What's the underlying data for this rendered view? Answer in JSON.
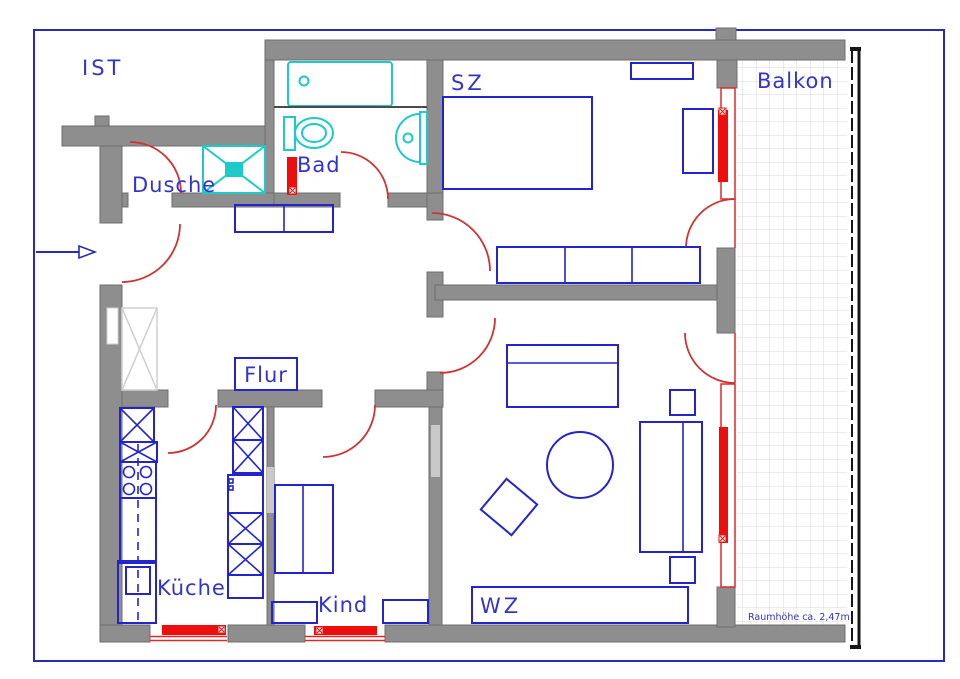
{
  "plan": {
    "rooms": [
      {
        "id": "ist",
        "label": "IST"
      },
      {
        "id": "dusche",
        "label": "Dusche"
      },
      {
        "id": "bad",
        "label": "Bad"
      },
      {
        "id": "sz",
        "label": "SZ"
      },
      {
        "id": "balkon",
        "label": "Balkon"
      },
      {
        "id": "flur",
        "label": "Flur"
      },
      {
        "id": "kueche",
        "label": "Küche"
      },
      {
        "id": "kind",
        "label": "Kind"
      },
      {
        "id": "wz",
        "label": "WZ"
      }
    ],
    "annotation": "Raumhöhe ca. 2,47m",
    "icons": {
      "entrance": "arrow-right"
    },
    "colors": {
      "wall": "#8e8e8e",
      "wallEdge": "#6d6d6d",
      "furniture": "#2424cc",
      "sanitary": "#1ec9c9",
      "radiator": "#ee0e0e",
      "door": "#cd3434",
      "window": "#e02828",
      "label": "#3434c8",
      "frame": "#2a2ab8",
      "grid": "#d8d8d8",
      "railing": "#161616",
      "lightFurniture": "#cfcfcf",
      "doorLeaf": "#c9c9c9"
    }
  }
}
